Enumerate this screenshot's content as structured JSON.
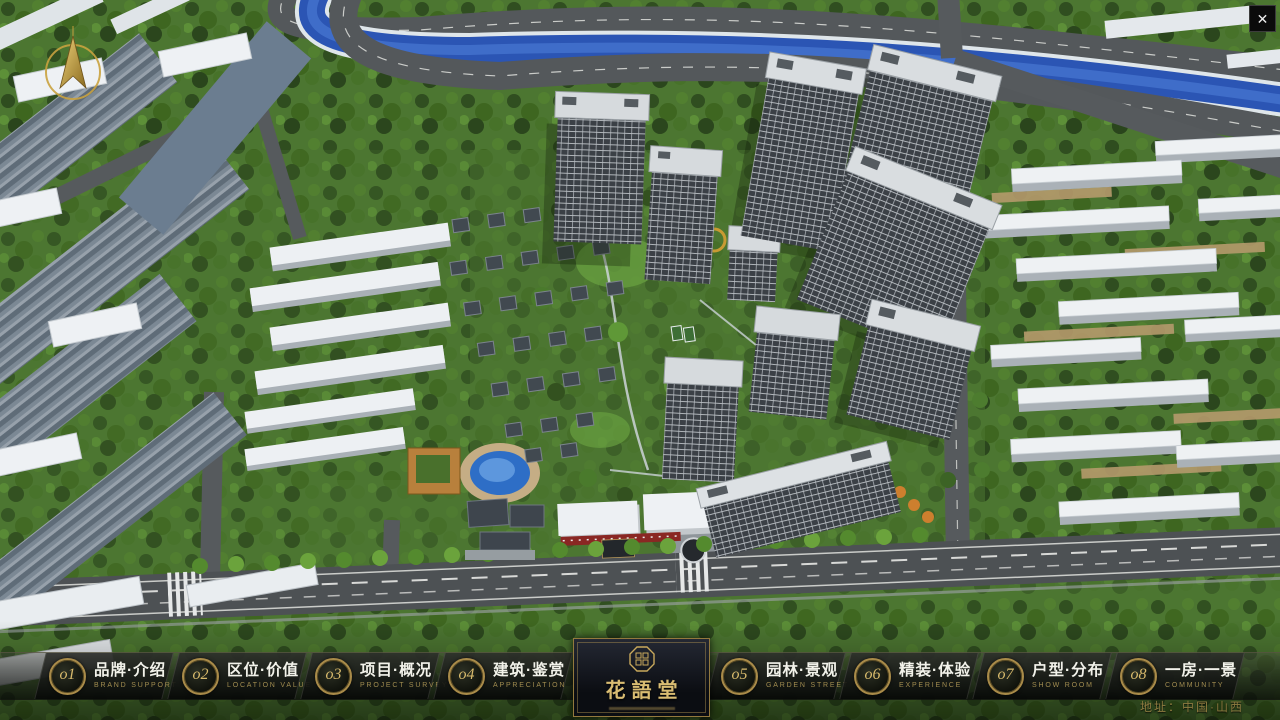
{
  "app": {
    "close_glyph": "✕"
  },
  "nav": {
    "items": [
      {
        "num": "o1",
        "title": "品牌·介绍",
        "subtitle": "BRAND SUPPORT"
      },
      {
        "num": "o2",
        "title": "区位·价值",
        "subtitle": "LOCATION VALUE"
      },
      {
        "num": "o3",
        "title": "项目·概况",
        "subtitle": "PROJECT SURVEY"
      },
      {
        "num": "o4",
        "title": "建筑·鉴赏",
        "subtitle": "APPRECIATION"
      },
      {
        "num": "o5",
        "title": "园林·景观",
        "subtitle": "GARDEN STREET"
      },
      {
        "num": "o6",
        "title": "精装·体验",
        "subtitle": "EXPERIENCE"
      },
      {
        "num": "o7",
        "title": "户型·分布",
        "subtitle": "SHOW ROOM"
      },
      {
        "num": "o8",
        "title": "一房·一景",
        "subtitle": "COMMUNITY"
      }
    ]
  },
  "logo": {
    "title": "花語堂"
  },
  "footer": {
    "address": "地址：中国·山西"
  },
  "colors": {
    "gold": "#c9a95c",
    "river": "#2b55b4",
    "storefront_red": "#8a2723",
    "navbar_bg": "#0c0e0a"
  }
}
